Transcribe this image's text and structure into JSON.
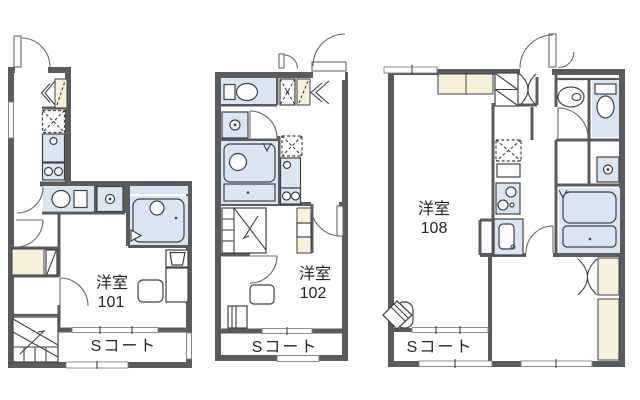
{
  "colors": {
    "wall": "#5a5b5e",
    "wet": "#d9e5f3",
    "closet": "#f8f0d8",
    "line": "#3e4144",
    "text": "#232528",
    "bg": "#ffffff"
  },
  "plans": [
    {
      "unit": "101",
      "room_type": "洋室",
      "balcony": "Sコート"
    },
    {
      "unit": "102",
      "room_type": "洋室",
      "balcony": "Sコート"
    },
    {
      "unit": "108",
      "room_type": "洋室",
      "balcony": "Sコート"
    }
  ]
}
